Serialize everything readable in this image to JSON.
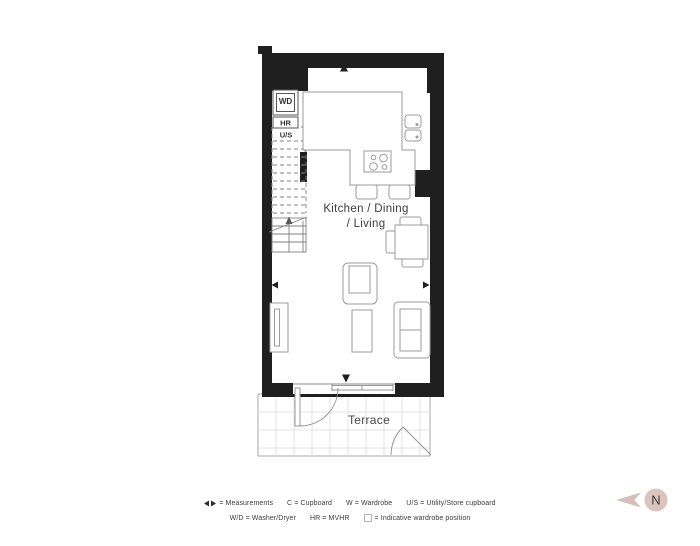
{
  "plan": {
    "room_label_line1": "Kitchen / Dining",
    "room_label_line2": "/ Living",
    "terrace_label": "Terrace",
    "units": {
      "wd": "WD",
      "hr": "HR",
      "us": "U/S"
    }
  },
  "legend": {
    "row1": [
      {
        "icon": "measure-arrows",
        "text": "= Measurements"
      },
      {
        "text": "C = Cupboard"
      },
      {
        "text": "W = Wardrobe"
      },
      {
        "text": "U/S = Utility/Store cupboard"
      }
    ],
    "row2": [
      {
        "text": "W/D = Washer/Dryer"
      },
      {
        "text": "HR = MVHR"
      },
      {
        "icon": "wardrobe-square",
        "text": "= Indicative wardrobe position"
      }
    ]
  },
  "compass": {
    "label": "N"
  },
  "colors": {
    "wall": "#1f1f1f",
    "furniture_line": "#9b9b9b",
    "detail_line": "#808080",
    "grid": "#dcdcdc",
    "text": "#3d3d3d",
    "compass_fill": "#dcc4be",
    "compass_arrow": "#d8beb8"
  }
}
